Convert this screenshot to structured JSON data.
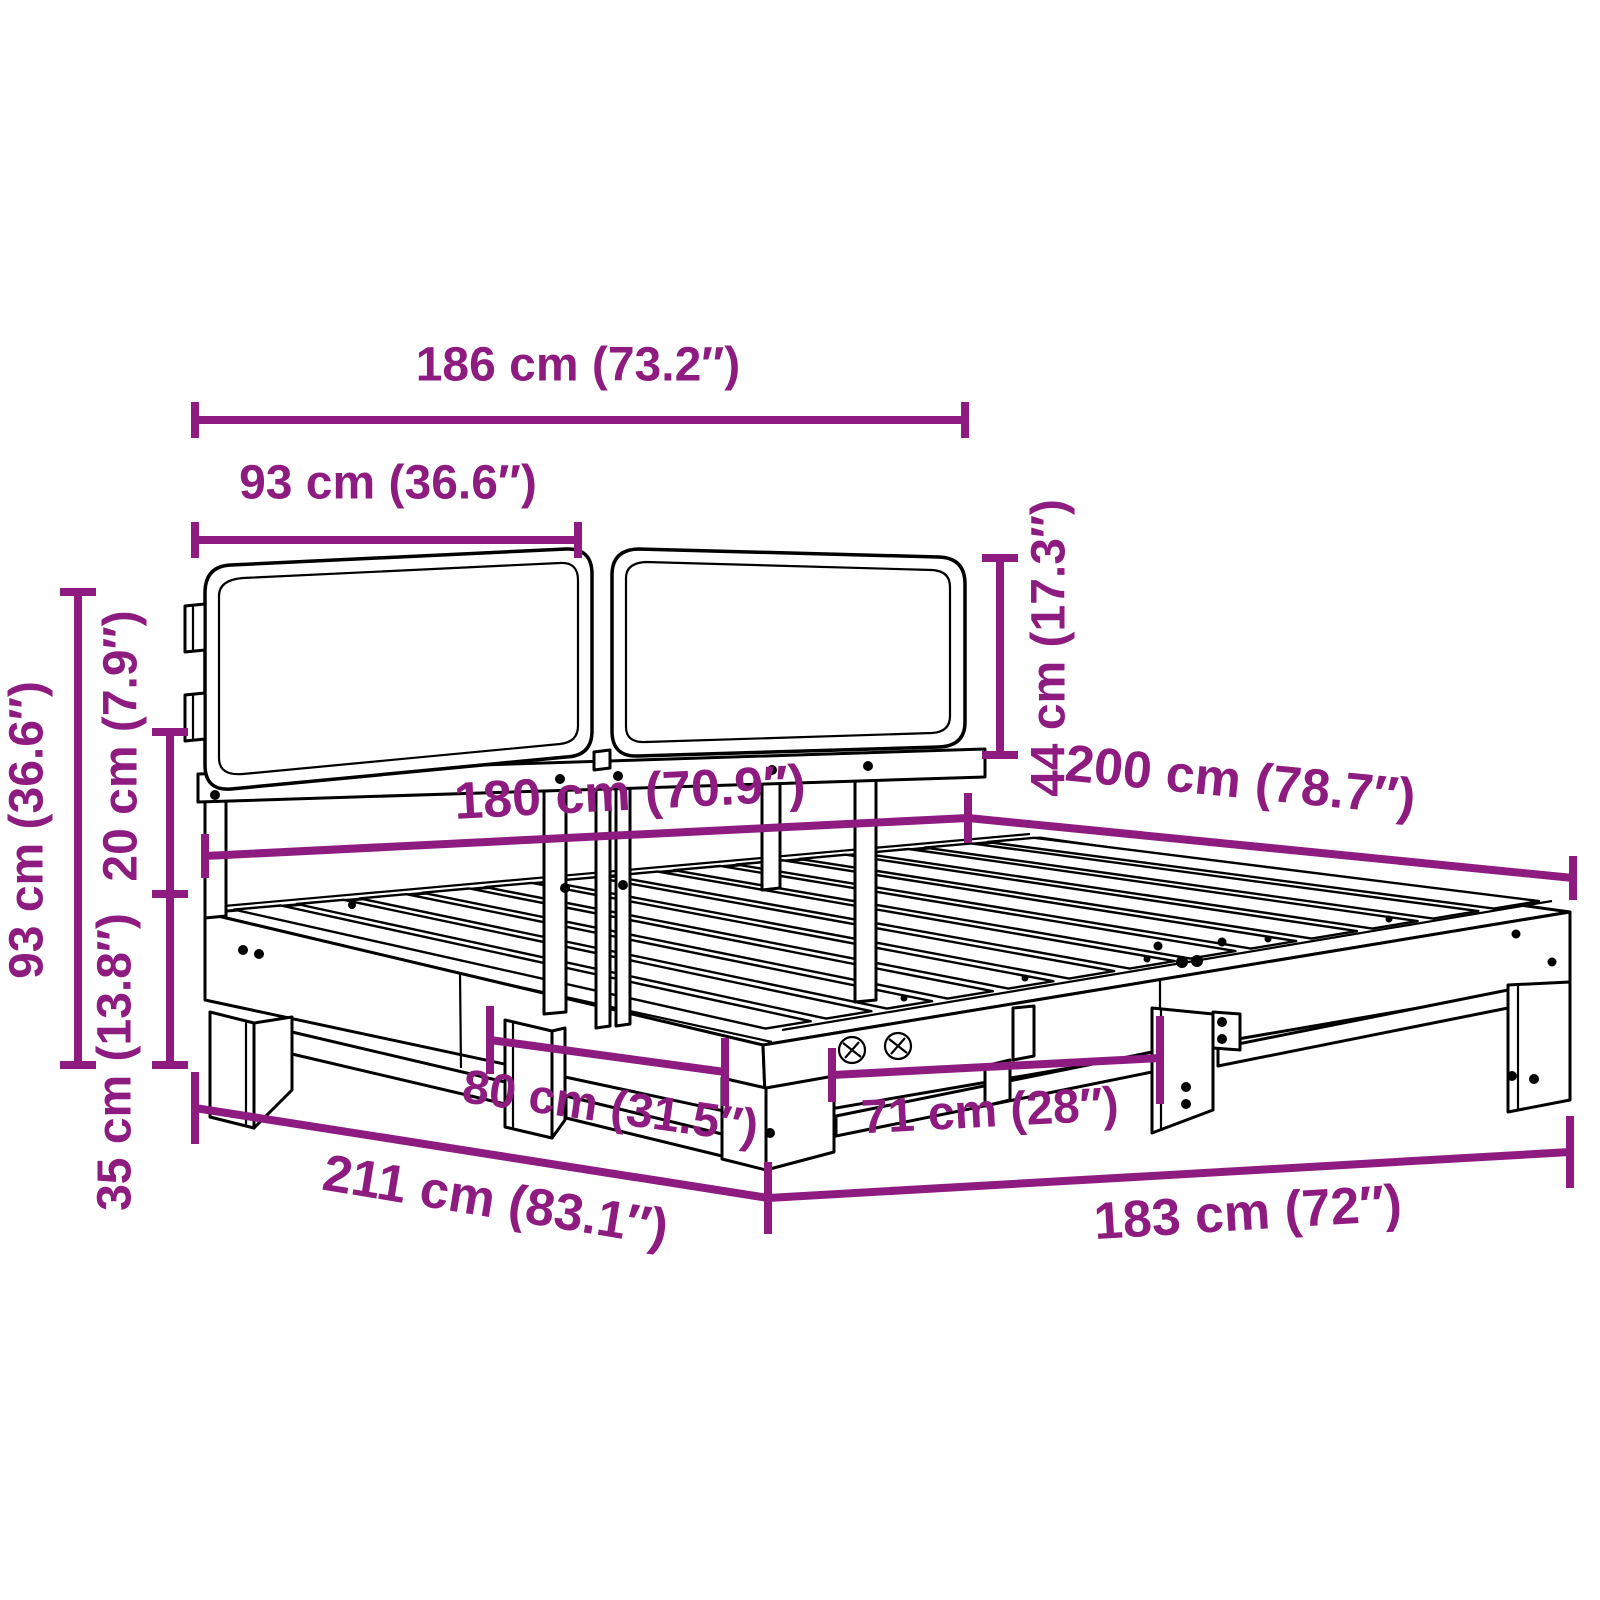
{
  "diagram": {
    "type": "furniture-dimension-diagram",
    "subject": "bed-frame-with-cushioned-headboard",
    "background_color": "#ffffff",
    "line_color": "#000000",
    "dimension_color": "#8e1b80",
    "units": [
      "cm",
      "inches"
    ],
    "dimensions": [
      {
        "id": "headboard_width",
        "label": "186 cm (73.2″)",
        "cm": 186,
        "inch": 73.2
      },
      {
        "id": "cushion_width",
        "label": "93 cm (36.6″)",
        "cm": 93,
        "inch": 36.6
      },
      {
        "id": "cushion_height",
        "label": "44 cm (17.3″)",
        "cm": 44,
        "inch": 17.3
      },
      {
        "id": "bed_width",
        "label": "180 cm (70.9″)",
        "cm": 180,
        "inch": 70.9
      },
      {
        "id": "bed_length",
        "label": "200 cm (78.7″)",
        "cm": 200,
        "inch": 78.7
      },
      {
        "id": "headboard_total_height",
        "label": "93 cm (36.6″)",
        "cm": 93,
        "inch": 36.6
      },
      {
        "id": "frame_rail_height",
        "label": "20 cm (7.9″)",
        "cm": 20,
        "inch": 7.9
      },
      {
        "id": "platform_height",
        "label": "35 cm (13.8″)",
        "cm": 35,
        "inch": 13.8
      },
      {
        "id": "side_leg_spacing",
        "label": "80 cm (31.5″)",
        "cm": 80,
        "inch": 31.5
      },
      {
        "id": "front_leg_spacing",
        "label": "71 cm (28″)",
        "cm": 71,
        "inch": 28
      },
      {
        "id": "total_length",
        "label": "211 cm (83.1″)",
        "cm": 211,
        "inch": 83.1
      },
      {
        "id": "total_width",
        "label": "183 cm (72″)",
        "cm": 183,
        "inch": 72
      }
    ]
  }
}
